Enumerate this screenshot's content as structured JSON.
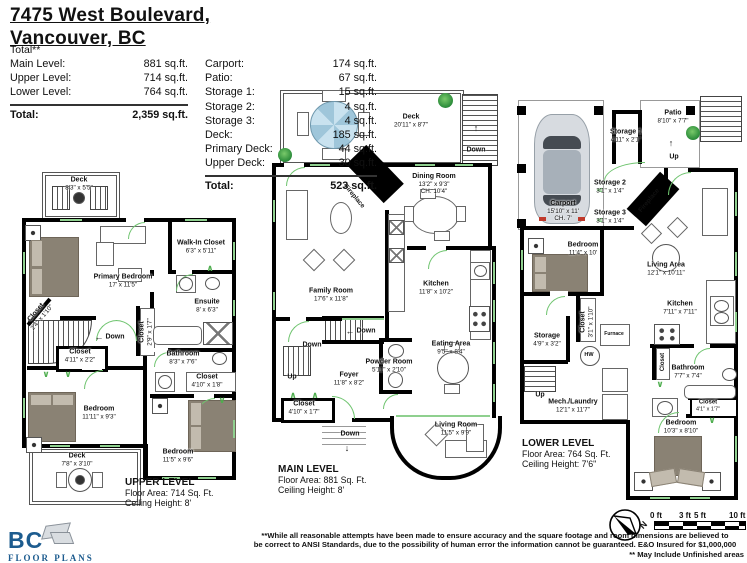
{
  "header": {
    "address_line1": "7475 West Boulevard,",
    "address_line2": "Vancouver, BC",
    "total_note": "Total**",
    "left_table": {
      "rows": [
        {
          "label": "Main Level:",
          "value": "881 sq.ft."
        },
        {
          "label": "Upper Level:",
          "value": "714 sq.ft."
        },
        {
          "label": "Lower Level:",
          "value": "764 sq.ft."
        }
      ],
      "total_label": "Total:",
      "total_value": "2,359 sq.ft."
    },
    "right_table": {
      "rows": [
        {
          "label": "Carport:",
          "value": "174 sq.ft."
        },
        {
          "label": "Patio:",
          "value": "67 sq.ft."
        },
        {
          "label": "Storage 1:",
          "value": "15 sq.ft."
        },
        {
          "label": "Storage 2:",
          "value": "4 sq.ft."
        },
        {
          "label": "Storage 3:",
          "value": "4 sq.ft."
        },
        {
          "label": "Deck:",
          "value": "185 sq.ft."
        },
        {
          "label": "Primary Deck:",
          "value": "44 sq.ft."
        },
        {
          "label": "Upper Deck:",
          "value": "30 sq.ft."
        }
      ],
      "total_label": "Total:",
      "total_value": "523 sq.ft."
    }
  },
  "icons": {
    "up_arrow": "↑",
    "down_arrow": "↓",
    "left_arrow": "←",
    "chev_down": "∨",
    "chev_up": "∧"
  },
  "plans": {
    "upper": {
      "title": "UPPER LEVEL",
      "area": "Floor Area: 714 Sq. Ft.",
      "ceiling": "Ceiling Height: 8'",
      "down": "Down",
      "rooms": [
        {
          "name": "Deck",
          "dims": "8'3\" x 5'5\""
        },
        {
          "name": "Primary Bedroom",
          "dims": "17' x 11'5\""
        },
        {
          "name": "Walk-In Closet",
          "dims": "6'3\" x 5'11\""
        },
        {
          "name": "Ensuite",
          "dims": "8' x 6'3\""
        },
        {
          "name": "Closet",
          "dims": "2'4\" x 1'10\""
        },
        {
          "name": "Closet",
          "dims": "4'11\" x 2'2\""
        },
        {
          "name": "Closet",
          "dims": "2'9\" x 1'7\""
        },
        {
          "name": "Bathroom",
          "dims": "8'3\" x 7'6\""
        },
        {
          "name": "Closet",
          "dims": "4'10\" x 1'8\""
        },
        {
          "name": "Bedroom",
          "dims": "11'11\" x 9'3\""
        },
        {
          "name": "Deck",
          "dims": "7'8\" x 3'10\""
        },
        {
          "name": "Bedroom",
          "dims": "11'5\" x 9'6\""
        }
      ]
    },
    "main": {
      "title": "MAIN LEVEL",
      "area": "Floor Area: 881 Sq. Ft.",
      "ceiling": "Ceiling Height: 8'",
      "down": "Down",
      "up": "Up",
      "fireplace": "Fireplace",
      "rooms": [
        {
          "name": "Deck",
          "dims": "20'11\" x 8'7\""
        },
        {
          "name": "Dining Room",
          "dims": "13'2\" x 9'3\"",
          "extra": "CH. 10'4\""
        },
        {
          "name": "Family Room",
          "dims": "17'6\" x 11'8\""
        },
        {
          "name": "Kitchen",
          "dims": "11'8\" x 10'2\""
        },
        {
          "name": "Powder Room",
          "dims": "5'11\" x 2'10\""
        },
        {
          "name": "Eating Area",
          "dims": "9'5\" x 8'4\""
        },
        {
          "name": "Foyer",
          "dims": "11'8\" x 8'2\""
        },
        {
          "name": "Closet",
          "dims": "4'10\" x 1'7\""
        },
        {
          "name": "Living Room",
          "dims": "11'5\" x 9'9\""
        }
      ]
    },
    "lower": {
      "title": "LOWER LEVEL",
      "area": "Floor Area: 764 Sq. Ft.",
      "ceiling": "Ceiling Height: 7'6\"",
      "up": "Up",
      "fireplace": "Fireplace",
      "rooms": [
        {
          "name": "Patio",
          "dims": "8'10\" x 7'7\""
        },
        {
          "name": "Storage 1",
          "dims": "4'11\" x 2'1\""
        },
        {
          "name": "Storage 2",
          "dims": "3'1\" x 1'4\""
        },
        {
          "name": "Storage 3",
          "dims": "3'1\" x 1'4\""
        },
        {
          "name": "Carport",
          "dims": "15'10\" x 11'",
          "extra": "CH. 7'"
        },
        {
          "name": "Bedroom",
          "dims": "11'4\" x 10'"
        },
        {
          "name": "Living Area",
          "dims": "12'1\" x 10'11\""
        },
        {
          "name": "Kitchen",
          "dims": "7'11\" x 7'11\""
        },
        {
          "name": "Closet",
          "dims": "3'1\" x 1'10\""
        },
        {
          "name": "Storage",
          "dims": "4'9\" x 3'2\""
        },
        {
          "name": "Furnace"
        },
        {
          "name": "HW"
        },
        {
          "name": "Closet"
        },
        {
          "name": "Bathroom",
          "dims": "7'7\" x 7'4\""
        },
        {
          "name": "Closet",
          "dims": "4'1\" x 1'7\""
        },
        {
          "name": "Bedroom",
          "dims": "10'3\" x 8'10\""
        },
        {
          "name": "Mech./Laundry",
          "dims": "12'1\" x 11'7\""
        }
      ]
    }
  },
  "footer": {
    "logo_line1": "BC",
    "logo_line2": "FLOOR PLANS",
    "disclaimer_line1": "**While all reasonable attempts have been made to ensure accuracy and the square footage and room dimensions are believed to",
    "disclaimer_line2": "be correct to ANSI Standards, due to the possibility of human error the information cannot be guaranteed. E&O Insured for $1,000,000",
    "disclaimer_line3": "** May Include Unfinished areas",
    "compass_n": "N",
    "scale": {
      "t0": "0 ft",
      "t3": "3 ft",
      "t5": "5 ft",
      "t10": "10 ft"
    }
  },
  "colors": {
    "wall": "#000000",
    "door_green": "#6fc46f",
    "bed_gray": "#8a8274",
    "logo_navy": "#1d5c8f",
    "table_blue": "#c9e2ef"
  }
}
